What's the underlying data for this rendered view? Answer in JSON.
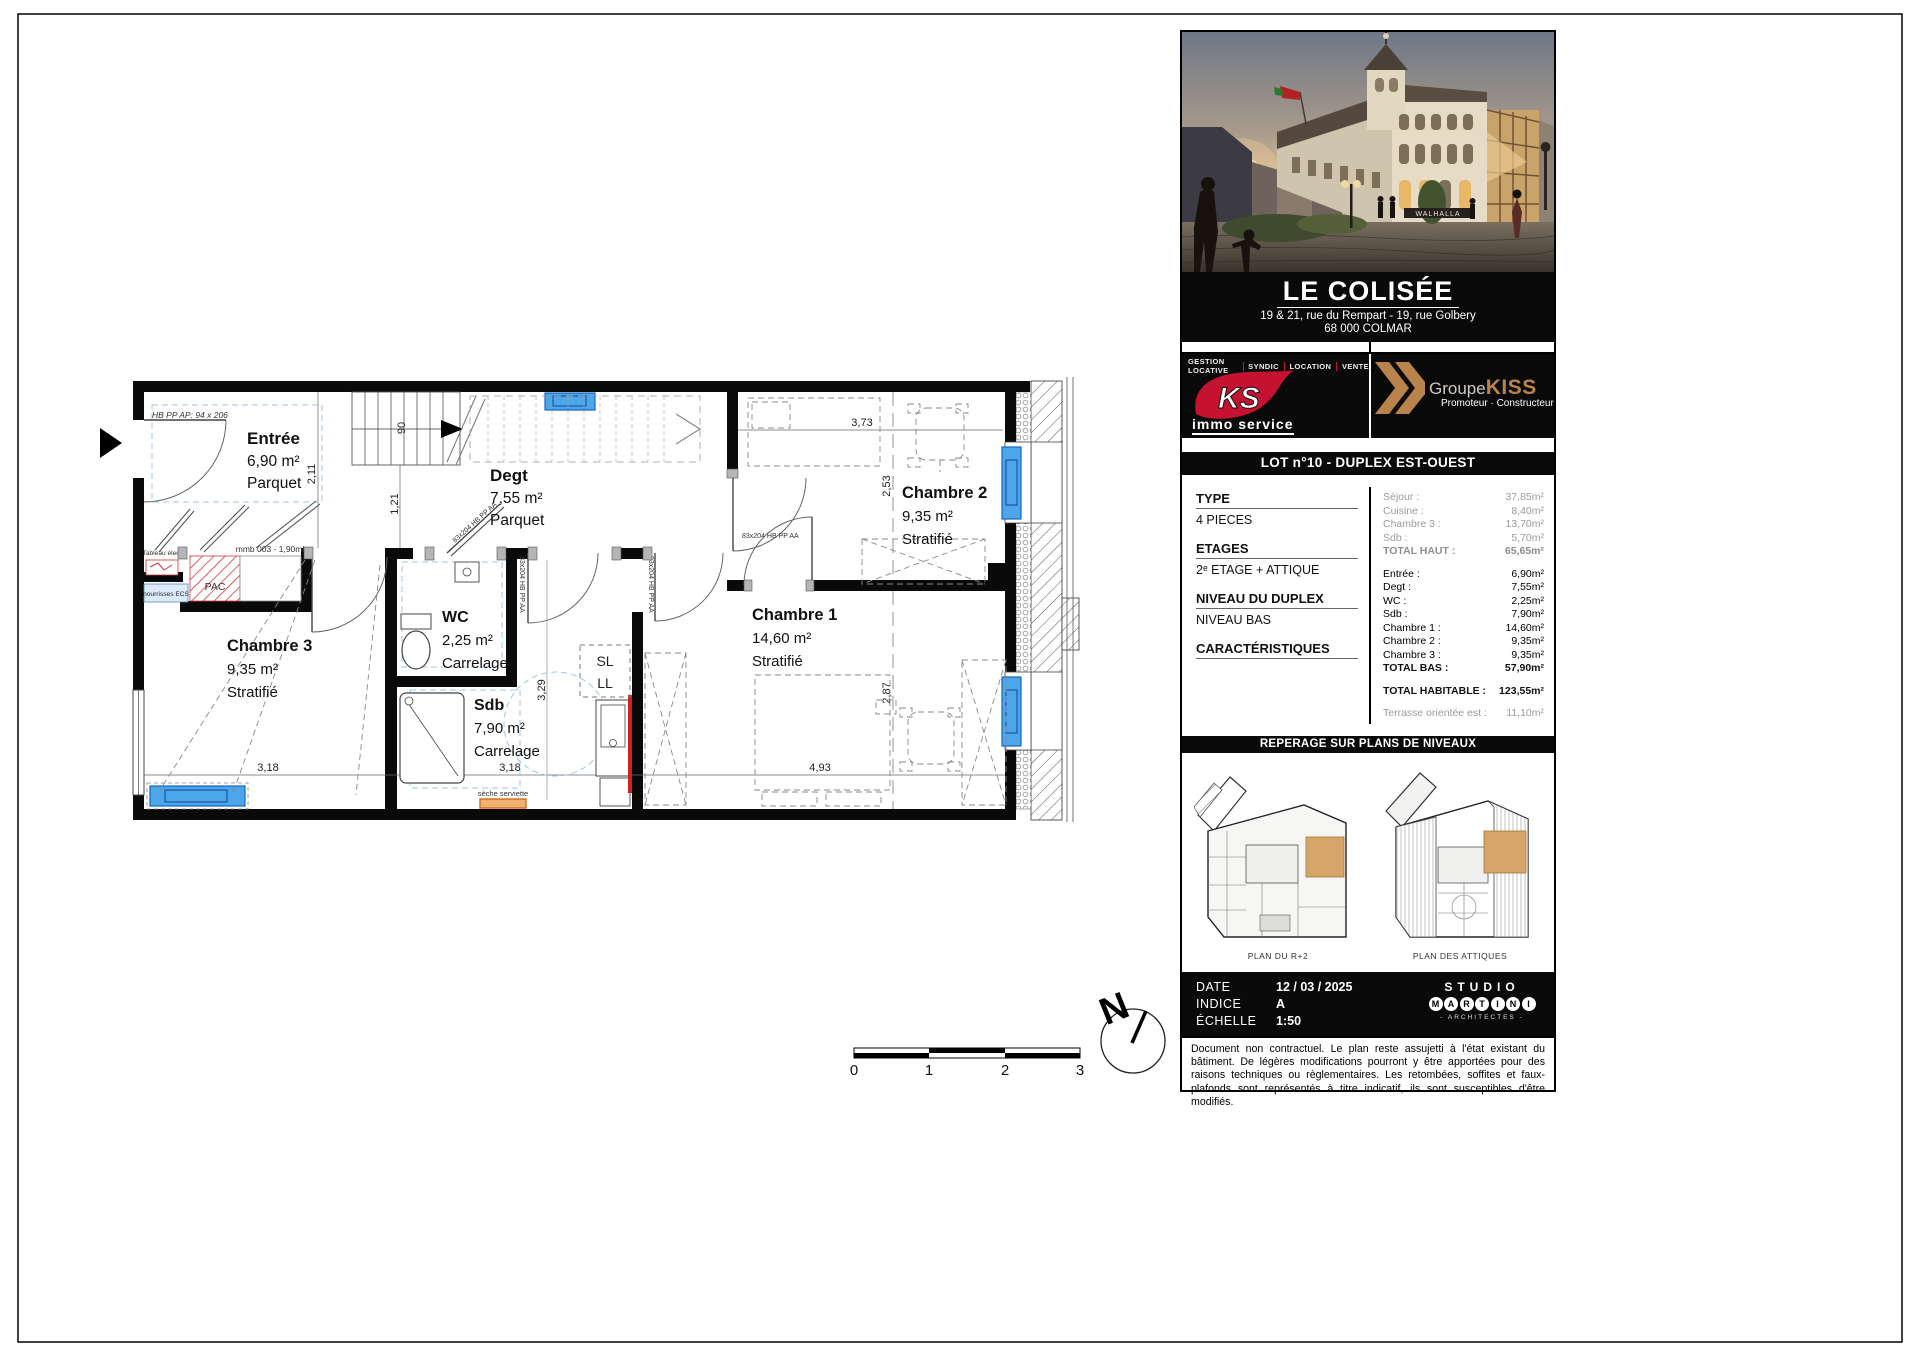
{
  "plan": {
    "rooms": [
      {
        "name": "Entrée",
        "area": "6,90 m²",
        "floor": "Parquet"
      },
      {
        "name": "Degt",
        "area": "7,55 m²",
        "floor": "Parquet"
      },
      {
        "name": "WC",
        "area": "2,25 m²",
        "floor": "Carrelage"
      },
      {
        "name": "Sdb",
        "area": "7,90 m²",
        "floor": "Carrelage"
      },
      {
        "name": "Chambre 1",
        "area": "14,60 m²",
        "floor": "Stratifié"
      },
      {
        "name": "Chambre 2",
        "area": "9,35 m²",
        "floor": "Stratifié"
      },
      {
        "name": "Chambre 3",
        "area": "9,35 m²",
        "floor": "Stratifié"
      }
    ],
    "dims": {
      "d211": "2,11",
      "d121": "1,21",
      "d90": "90",
      "d373": "3,73",
      "d253": "2,53",
      "d287": "2,87",
      "d493": "4,93",
      "d318a": "3,18",
      "d318b": "3,18",
      "d329": "3,29"
    },
    "labels": {
      "entry_door": "HB PP AP: 94 x 206",
      "door": "83x204  HB PP AA",
      "closet": "mmb 003 - 1,90ml",
      "pac": "PAC",
      "ecs": "nourrisses ECS",
      "tableau": "Tableau élec.",
      "seche": "sèche serviette",
      "sl": "SL",
      "ll": "LL"
    },
    "north": "N",
    "scale": [
      "0",
      "1",
      "2",
      "3"
    ]
  },
  "panel": {
    "photo": {
      "sign": "WALHALLA"
    },
    "title": "LE COLISÉE",
    "address1": "19 & 21, rue du Rempart - 19, rue Golbery",
    "address2": "68 000 COLMAR",
    "menu": [
      "GESTION LOCATIVE",
      "SYNDIC",
      "LOCATION",
      "VENTE"
    ],
    "ks": {
      "mark": "KS",
      "name": "immo service"
    },
    "kiss": {
      "groupe": "Groupe",
      "kiss": "KISS",
      "sub": "Promoteur · Constructeur"
    },
    "lot": "LOT n°10 - DUPLEX EST-OUEST",
    "type": {
      "label": "TYPE",
      "value": "4 PIECES"
    },
    "etages": {
      "label": "ETAGES",
      "value": "2ᵉ ETAGE + ATTIQUE"
    },
    "niveau": {
      "label": "NIVEAU DU DUPLEX",
      "value": "NIVEAU BAS"
    },
    "carac": {
      "label": "CARACTÉRISTIQUES"
    },
    "surfaces_haut": [
      {
        "label": "Séjour :",
        "value": "37,85m²"
      },
      {
        "label": "Cuisine :",
        "value": "8,40m²"
      },
      {
        "label": "Chambre 3 :",
        "value": "13,70m²"
      },
      {
        "label": "Sdb :",
        "value": "5,70m²"
      }
    ],
    "total_haut": {
      "label": "TOTAL HAUT :",
      "value": "65,65m²"
    },
    "surfaces_bas": [
      {
        "label": "Entrée :",
        "value": "6,90m²"
      },
      {
        "label": "Degt :",
        "value": "7,55m²"
      },
      {
        "label": "WC :",
        "value": "2,25m²"
      },
      {
        "label": "Sdb :",
        "value": "7,90m²"
      },
      {
        "label": "Chambre 1 :",
        "value": "14,60m²"
      },
      {
        "label": "Chambre 2 :",
        "value": "9,35m²"
      },
      {
        "label": "Chambre 3 :",
        "value": "9,35m²"
      }
    ],
    "total_bas": {
      "label": "TOTAL BAS :",
      "value": "57,90m²"
    },
    "total_hab": {
      "label": "TOTAL HABITABLE :",
      "value": "123,55m²"
    },
    "terrasse": {
      "label": "Terrasse orientée est :",
      "value": "11,10m²"
    },
    "reperage": "REPERAGE SUR PLANS DE NIVEAUX",
    "plan_labels": [
      "PLAN DU R+2",
      "PLAN DES ATTIQUES"
    ],
    "meta": {
      "date_label": "DATE",
      "date": "12 / 03 / 2025",
      "indice_label": "INDICE",
      "indice": "A",
      "echelle_label": "ÉCHELLE",
      "echelle": "1:50"
    },
    "studio": {
      "line1": "STUDIO",
      "letters": [
        "M",
        "A",
        "R",
        "T",
        "I",
        "N",
        "I"
      ],
      "sub": "- ARCHITECTES -"
    },
    "disclaimer": "Document non contractuel. Le plan reste assujetti à l'état existant du bâtiment. De légères modifications pourront y être apportées pour des raisons techniques ou règlementaires. Les retombées, soffites et faux-plafonds sont représentés à titre indicatif, ils sont susceptibles d'être modifiés."
  },
  "colors": {
    "accent_red": "#c41230",
    "gold": "#b9834c",
    "radiator_blue": "#4da6e8",
    "highlight_tan": "#d6a568",
    "pac_red": "#d03a3a",
    "seche_orange": "#d2691e"
  }
}
